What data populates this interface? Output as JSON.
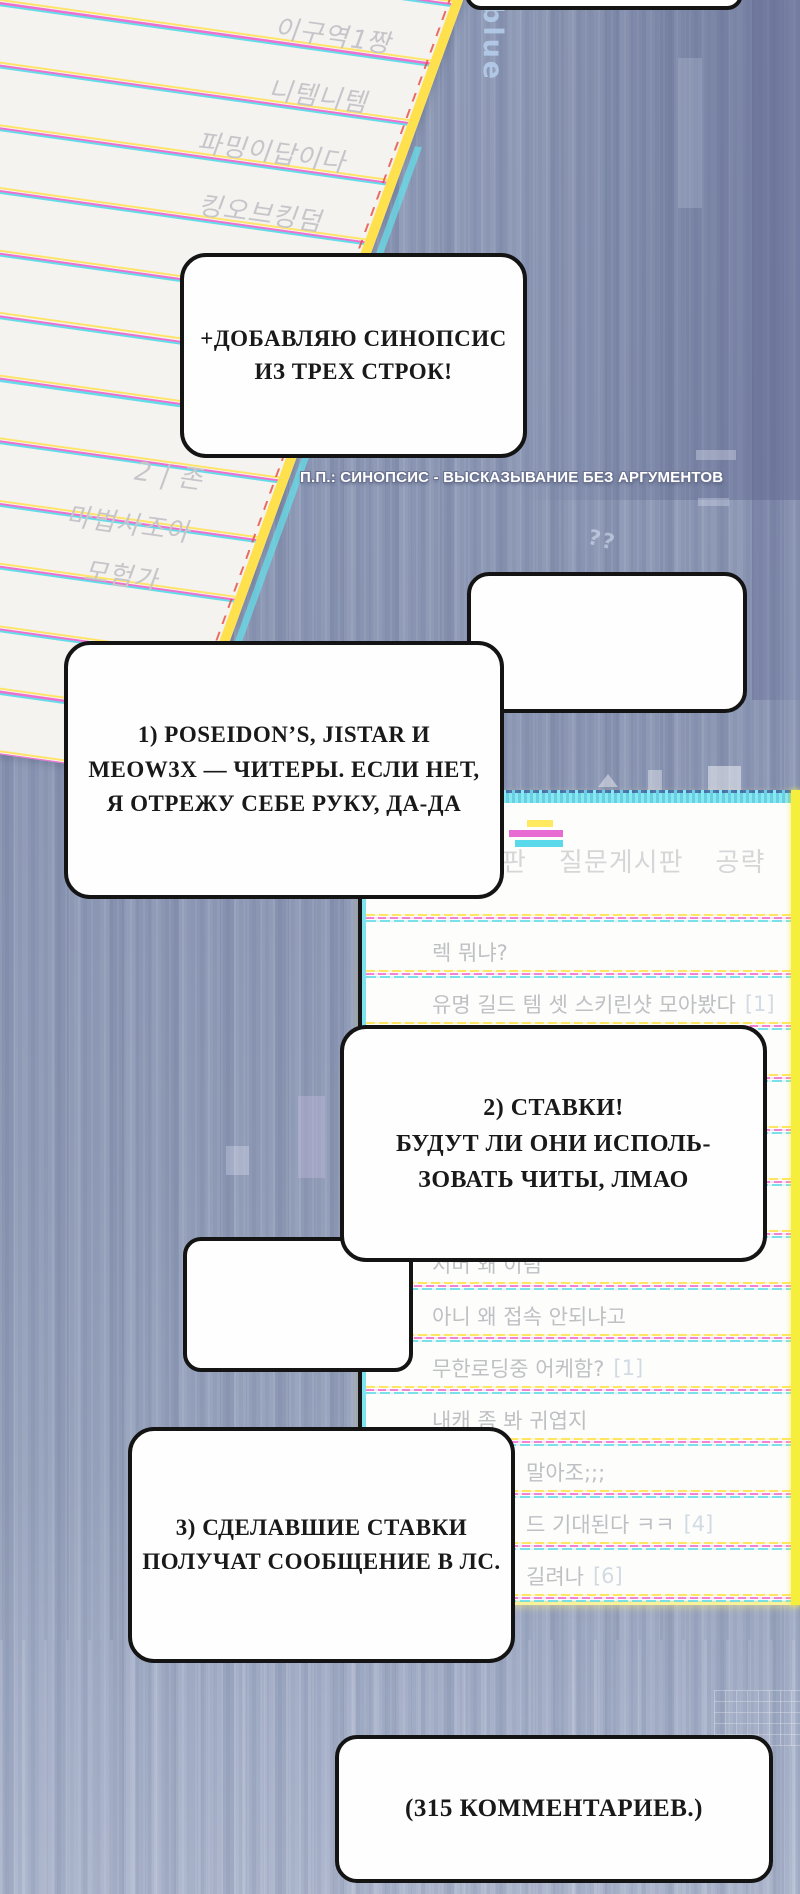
{
  "page": {
    "type": "webtoon-panel",
    "language": "ru-ko"
  },
  "colors": {
    "background": "#8d99b6",
    "bubble_border": "#141414",
    "paper_rule_yellow": "#ffe468",
    "paper_rule_magenta": "#ef6fd0",
    "paper_rule_cyan": "#64dbe8",
    "panel_cyan_strip": "#86e8f0",
    "panel_yellow_strip": "#f6ee3c",
    "forum_text_gray": "#bfc0c4"
  },
  "watermarks": {
    "blue_label": "blue",
    "glitch_marks": "??"
  },
  "paper": {
    "entries": [
      "이구역1짱",
      "니템니템",
      "파밍이답이다",
      "킹오브킹덤",
      "2 | 존",
      "마법사조아",
      "모험가"
    ]
  },
  "bubbles": {
    "top_partial": "",
    "synopsis": "+ДОБАВЛЯЮ СИНОПСИС\nИЗ ТРЕХ СТРОК!",
    "empty": "",
    "point_one": "1) POSEIDON’S, JISTAR И\nMEOW3X — ЧИТЕРЫ. ЕСЛИ НЕТ,\nЯ ОТРЕЖУ СЕБЕ РУКУ, ДА-ДА",
    "point_two": "2) СТАВКИ!\nБУДУТ ЛИ ОНИ ИСПОЛЬ-\nЗОВАТЬ ЧИТЫ, ЛМАО",
    "small_empty": "",
    "point_three": "3) СДЕЛАВШИЕ СТАВКИ\nПОЛУЧАТ СООБЩЕНИЕ В ЛС.",
    "comments": "(315 КОММЕНТАРИЕВ.)"
  },
  "caption": {
    "text": "П.П.: СИНОПСИС - ВЫСКАЗЫВАНИЕ БЕЗ АРГУМЕНТОВ"
  },
  "forum": {
    "tabs": [
      "판",
      "질문게시판",
      "공략"
    ],
    "rows": [
      {
        "text": "렉 뭐냐?",
        "badge": ""
      },
      {
        "text": "유명 길드 템 셋 스키린샷 모아봤다",
        "badge": "[1]"
      },
      {
        "text": "",
        "badge": ""
      },
      {
        "text": "",
        "badge": ""
      },
      {
        "text": "",
        "badge": ""
      },
      {
        "text": "",
        "badge": ""
      },
      {
        "text": "서버 왜 이럼",
        "badge": ""
      },
      {
        "text": "아니 왜 접속 안되냐고",
        "badge": ""
      },
      {
        "text": "무한로딩중 어케함?",
        "badge": "[1]"
      },
      {
        "text": "내캐 좀 봐 귀엽지",
        "badge": ""
      },
      {
        "text": "말아조;;;",
        "badge": "",
        "cut": true
      },
      {
        "text": "드 기대된다 ㅋㅋ",
        "badge": "[4]",
        "cut": true
      },
      {
        "text": "길려나",
        "badge": "[6]",
        "cut": true
      }
    ]
  }
}
